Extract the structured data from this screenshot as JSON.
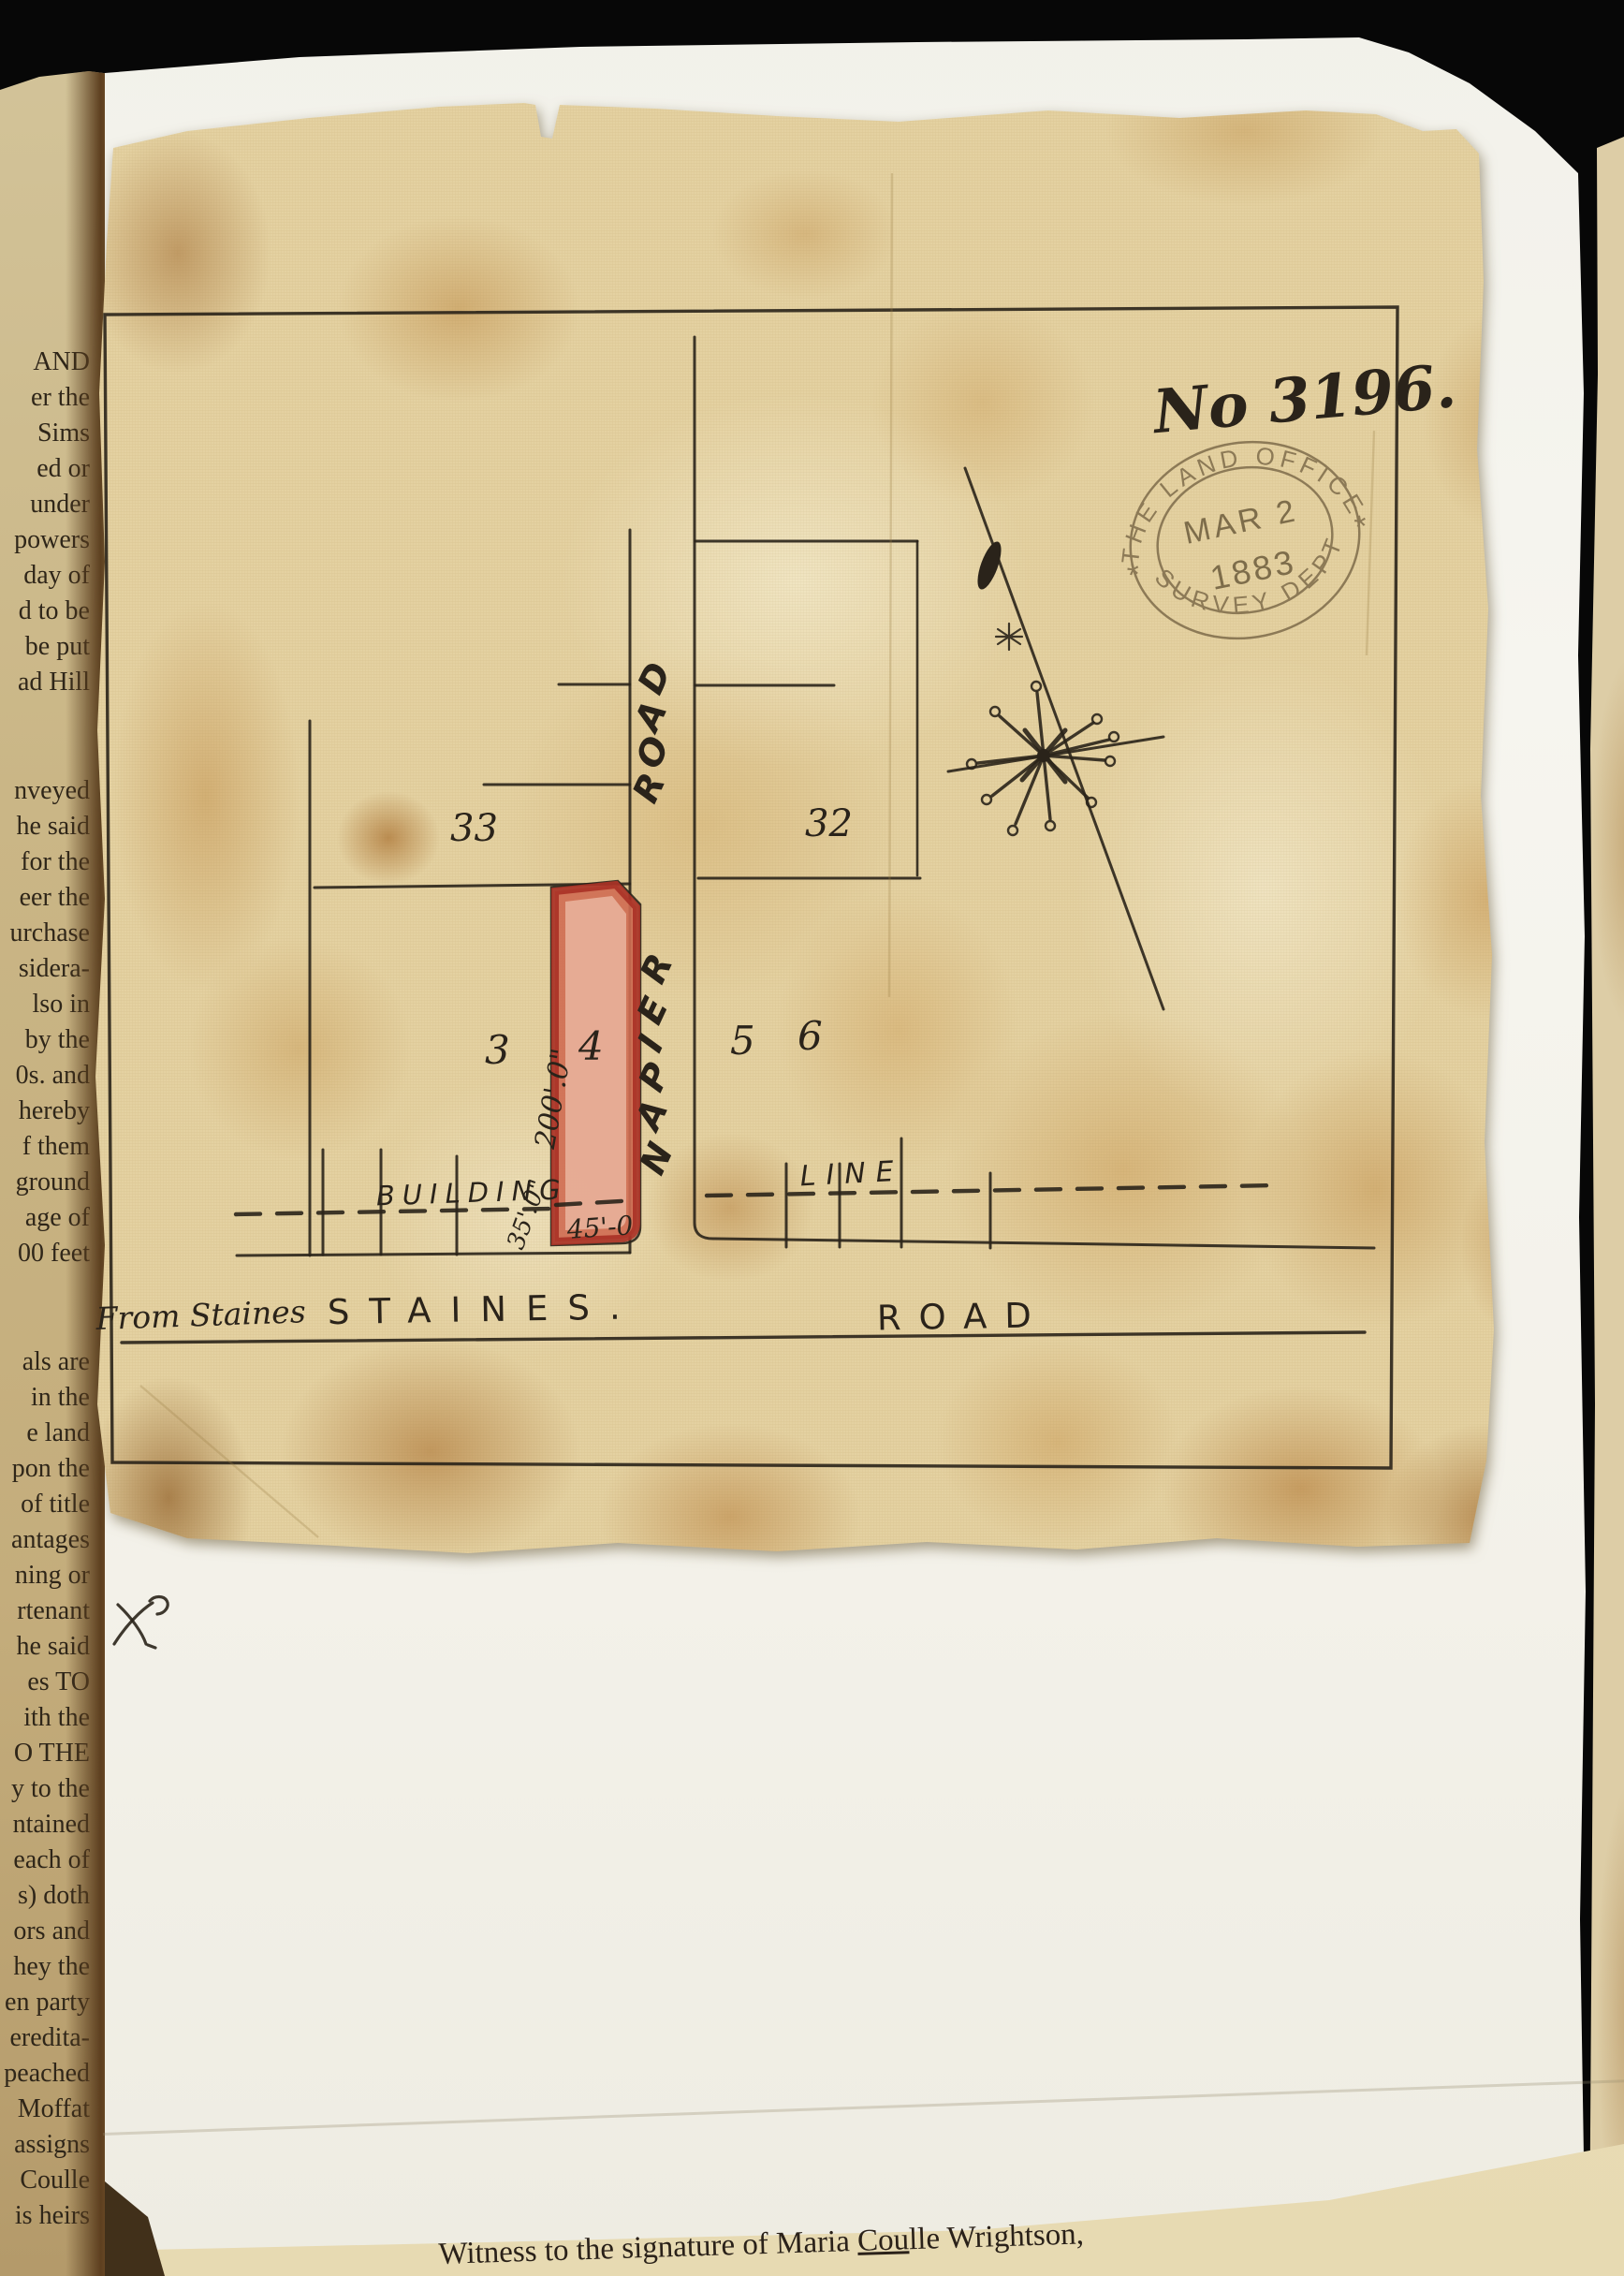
{
  "left_page": {
    "fragments": [
      "AND",
      "er the",
      "Sims",
      "ed or",
      "under",
      "powers",
      "day of",
      "d to be",
      "be put",
      "ad Hill",
      "nveyed",
      "he said",
      "for the",
      "eer the",
      "urchase",
      "sidera-",
      "lso in",
      "by the",
      "0s. and",
      "hereby",
      "f them",
      "ground",
      "age of",
      "00 feet",
      "als are",
      "in the",
      "e land",
      "pon the",
      "of title",
      "antages",
      "ning or",
      "rtenant",
      "he said",
      "es TO",
      "ith the",
      "O THE",
      "y to the",
      "ntained",
      "each of",
      "s) doth",
      "ors and",
      "hey the",
      "en party",
      "eredita-",
      "peached",
      "Moffat",
      "assigns",
      "Coulle",
      "is heirs"
    ]
  },
  "map": {
    "number_annotation": "No 3196.",
    "stamp": {
      "top_text": "THE LAND OFFICE",
      "date_line1": "MAR 2",
      "date_line2": "1883",
      "bottom_text": "SURVEY DEPT",
      "side_marks": "*"
    },
    "plot_labels": {
      "block_left": "33",
      "block_right": "32",
      "lot_3": "3",
      "lot_4": "4",
      "lot_5": "5",
      "lot_6": "6"
    },
    "napier_road": "NAPIER ROAD",
    "napier_road_letters": [
      "D",
      "A",
      "O",
      "R",
      "R",
      "E",
      "I",
      "P",
      "A",
      "N"
    ],
    "building_line": {
      "left_word": "BUILDING",
      "right_word": "LINE"
    },
    "measurements": {
      "depth": "200'.0\"",
      "frontage": "45'-0",
      "offset": "35'.0\""
    },
    "staines_road": {
      "handwritten_prefix": "From Staines",
      "street_caps": "STAINES.",
      "road_caps": "ROAD"
    }
  },
  "witness_strip": {
    "prefix": "Witness to the signature of Maria ",
    "underlined": "Cou",
    "suffix": "lle Wrightson,"
  },
  "colors": {
    "plot_fill": "#cf6b52",
    "plot_inner": "#eab59f",
    "plot_border": "#a93226",
    "ink": "#2a231a",
    "stamp_ink": "#7a6847",
    "cloth": "#e4d1a1",
    "backing_sheet": "#f4f2ea",
    "book_page": "#c9b383",
    "witness_paper": "#e9ddb8",
    "background": "#070707"
  }
}
